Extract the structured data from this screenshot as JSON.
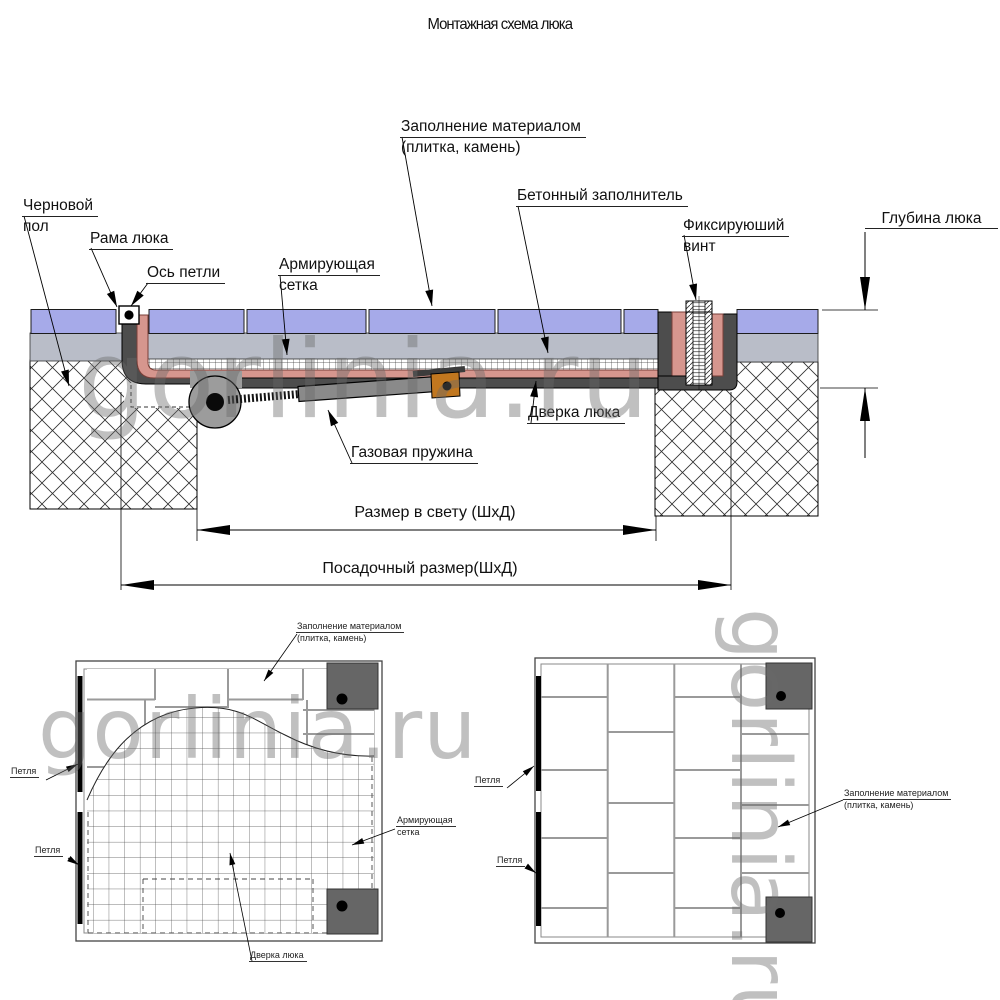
{
  "title": "Монтажная схема люка",
  "watermark": "gorlinia.ru",
  "section": {
    "labels": {
      "subfloor_1": "Черновой",
      "subfloor_2": "пол",
      "frame": "Рама люка",
      "hinge_axis": "Ось петли",
      "mesh_1": "Армирующая",
      "mesh_2": "сетка",
      "fill_1": "Заполнение материалом",
      "fill_2": "(плитка, камень)",
      "concrete": "Бетонный заполнитель",
      "screw_1": "Фиксируюший",
      "screw_2": "винт",
      "depth": "Глубина люка",
      "gas_spring": "Газовая пружина",
      "door": "Дверка люка"
    },
    "dimensions": {
      "clear_size": "Размер в свету (ШхД)",
      "mounting_size": "Посадочный размер(ШхД)"
    }
  },
  "plan_left": {
    "fill_1": "Заполнение материалом",
    "fill_2": "(плитка, камень)",
    "hinge_top": "Петля",
    "hinge_bottom": "Петля",
    "mesh_1": "Армирующая",
    "mesh_2": "сетка",
    "door": "Дверка люка"
  },
  "plan_right": {
    "hinge_top": "Петля",
    "hinge_bottom": "Петля",
    "fill_1": "Заполнение материалом",
    "fill_2": "(плитка, камень)"
  },
  "colors": {
    "tile": "#a6aae9",
    "screed": "#b9bdc8",
    "frame_dark": "#4d4d4d",
    "door_tray": "#d6968e",
    "hinge_gray": "#9c9c9c",
    "spring_body": "#8a8a8a",
    "clevis_orange": "#c1771f",
    "plan_square": "#666666"
  }
}
